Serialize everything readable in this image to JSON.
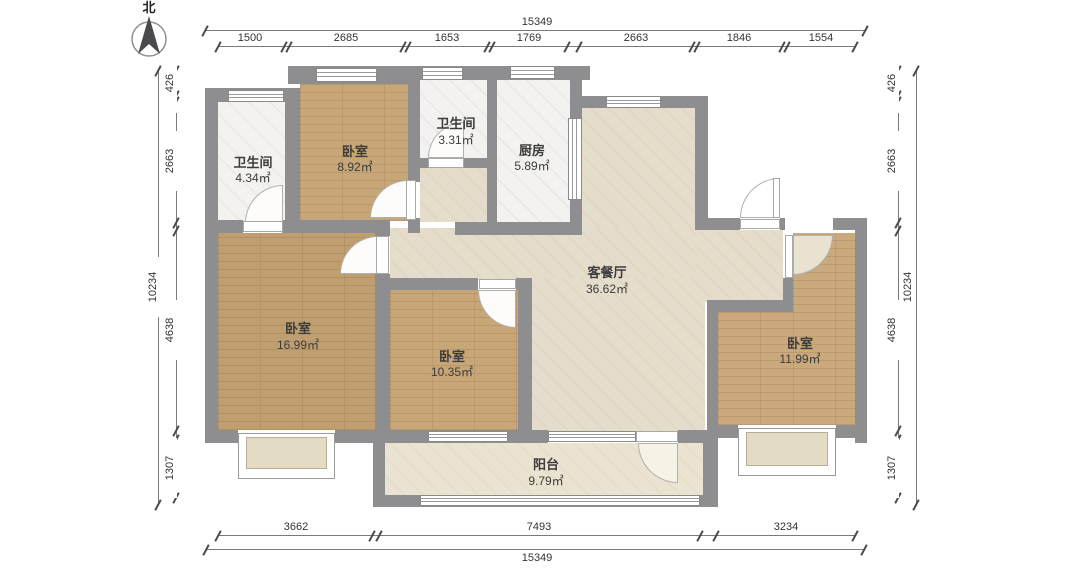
{
  "compass": {
    "north_label": "北"
  },
  "rooms": [
    {
      "id": "bathroom-left",
      "name": "卫生间",
      "area": "4.34㎡"
    },
    {
      "id": "bedroom-top",
      "name": "卧室",
      "area": "8.92㎡"
    },
    {
      "id": "bathroom-mid",
      "name": "卫生间",
      "area": "3.31㎡"
    },
    {
      "id": "kitchen",
      "name": "厨房",
      "area": "5.89㎡"
    },
    {
      "id": "living-dining",
      "name": "客餐厅",
      "area": "36.62㎡"
    },
    {
      "id": "bedroom-left",
      "name": "卧室",
      "area": "16.99㎡"
    },
    {
      "id": "bedroom-mid",
      "name": "卧室",
      "area": "10.35㎡"
    },
    {
      "id": "bedroom-right",
      "name": "卧室",
      "area": "11.99㎡"
    },
    {
      "id": "balcony",
      "name": "阳台",
      "area": "9.79㎡"
    }
  ],
  "dims": {
    "top": {
      "total": "15349",
      "segments": [
        "1500",
        "2685",
        "1653",
        "1769",
        "2663",
        "1846",
        "1554"
      ]
    },
    "bottom": {
      "total": "15349",
      "segments": [
        "3662",
        "7493",
        "3234"
      ]
    },
    "left": {
      "total": "10234",
      "segments": [
        "426",
        "2663",
        "4638",
        "1307"
      ]
    },
    "right": {
      "total": "10234",
      "segments": [
        "426",
        "2663",
        "4638",
        "1307"
      ]
    }
  },
  "colors": {
    "wall": "#8e8e90",
    "wood_floor": "#c7a678",
    "tile_floor": "#e5ddcb",
    "bath_floor": "#f3f2f0",
    "dimension_text": "#333333"
  }
}
